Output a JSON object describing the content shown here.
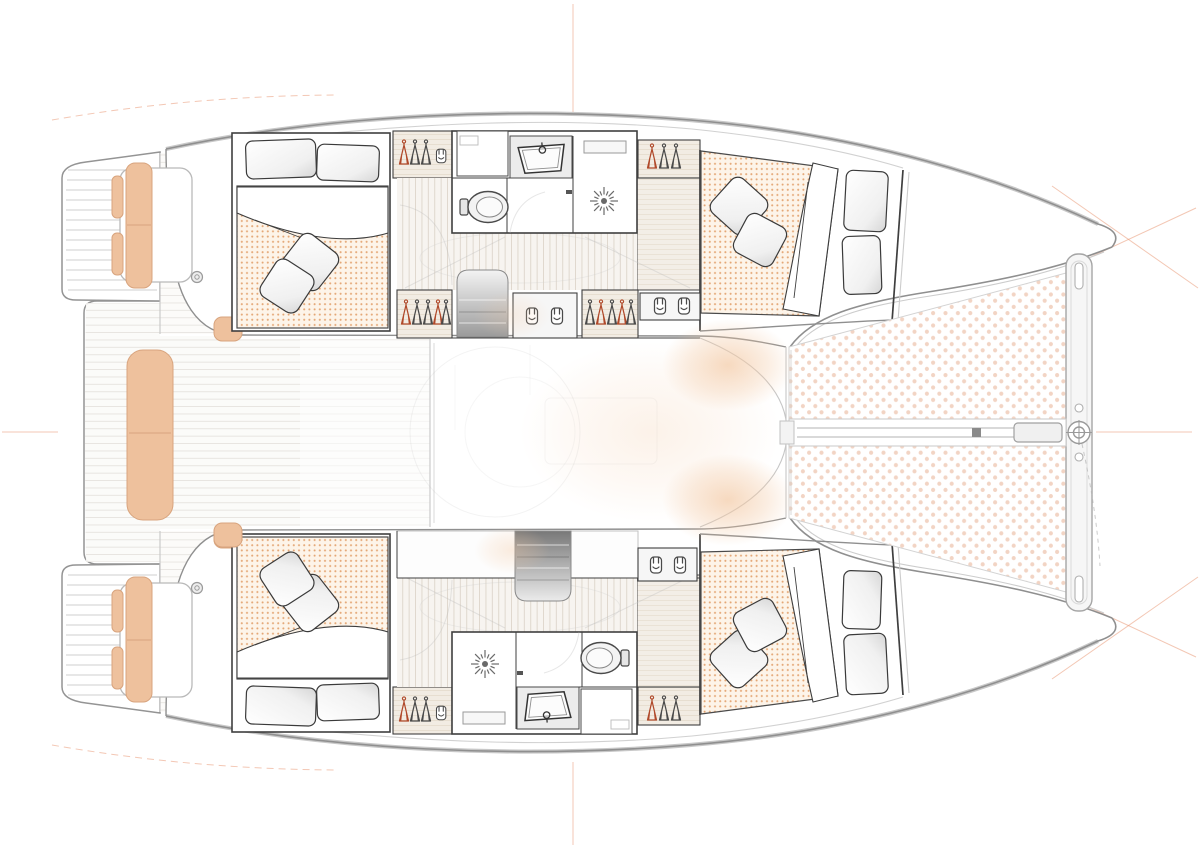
{
  "meta": {
    "title": "Catamaran interior layout — overhead floor plan",
    "view": "top-down"
  },
  "palette": {
    "hull_line": "#8f8f8f",
    "wall": "#3f3f3f",
    "light_line": "#c8c8c8",
    "cushion": "#eec19d",
    "cushion_edge": "#d8a47e",
    "mattress_dot": "#df9a62",
    "tramp_dot": "#e9b89d",
    "glow": "#f3c9a4",
    "guide": "#e8906a",
    "icon": "#4a4a4a",
    "icon_red": "#b0492a"
  },
  "areas": {
    "stern": [
      "swim-platform-port",
      "swim-platform-starboard",
      "aft-platform",
      "aft-bench",
      "quarter-seat-port",
      "quarter-seat-starboard"
    ],
    "center": [
      "cockpit",
      "salon",
      "companionway-port",
      "companionway-starboard"
    ],
    "port_hull": [
      "aft-cabin",
      "bathroom",
      "corridor",
      "wardrobes",
      "forward-cabin",
      "bow-storage"
    ],
    "starboard_hull": [
      "aft-cabin",
      "bathroom",
      "corridor",
      "wardrobes",
      "forward-cabin",
      "bow-storage"
    ],
    "bow": [
      "trampoline-port",
      "trampoline-starboard",
      "forward-crossbeam",
      "bowsprit"
    ]
  },
  "icons": {
    "wardrobe": "hanger-icon",
    "shoe_locker": "boot-icon",
    "shower": "sun-rays-icon",
    "toilet": "oval-toilet-icon",
    "sink": "basin-faucet-icon",
    "stairs": "gradient-steps",
    "trampoline": "dot-mesh",
    "winch": "circle"
  },
  "counts": {
    "double_beds": 4,
    "bathrooms": 2,
    "companionway_stairs": 2,
    "trampolines": 2,
    "winches": 2
  }
}
